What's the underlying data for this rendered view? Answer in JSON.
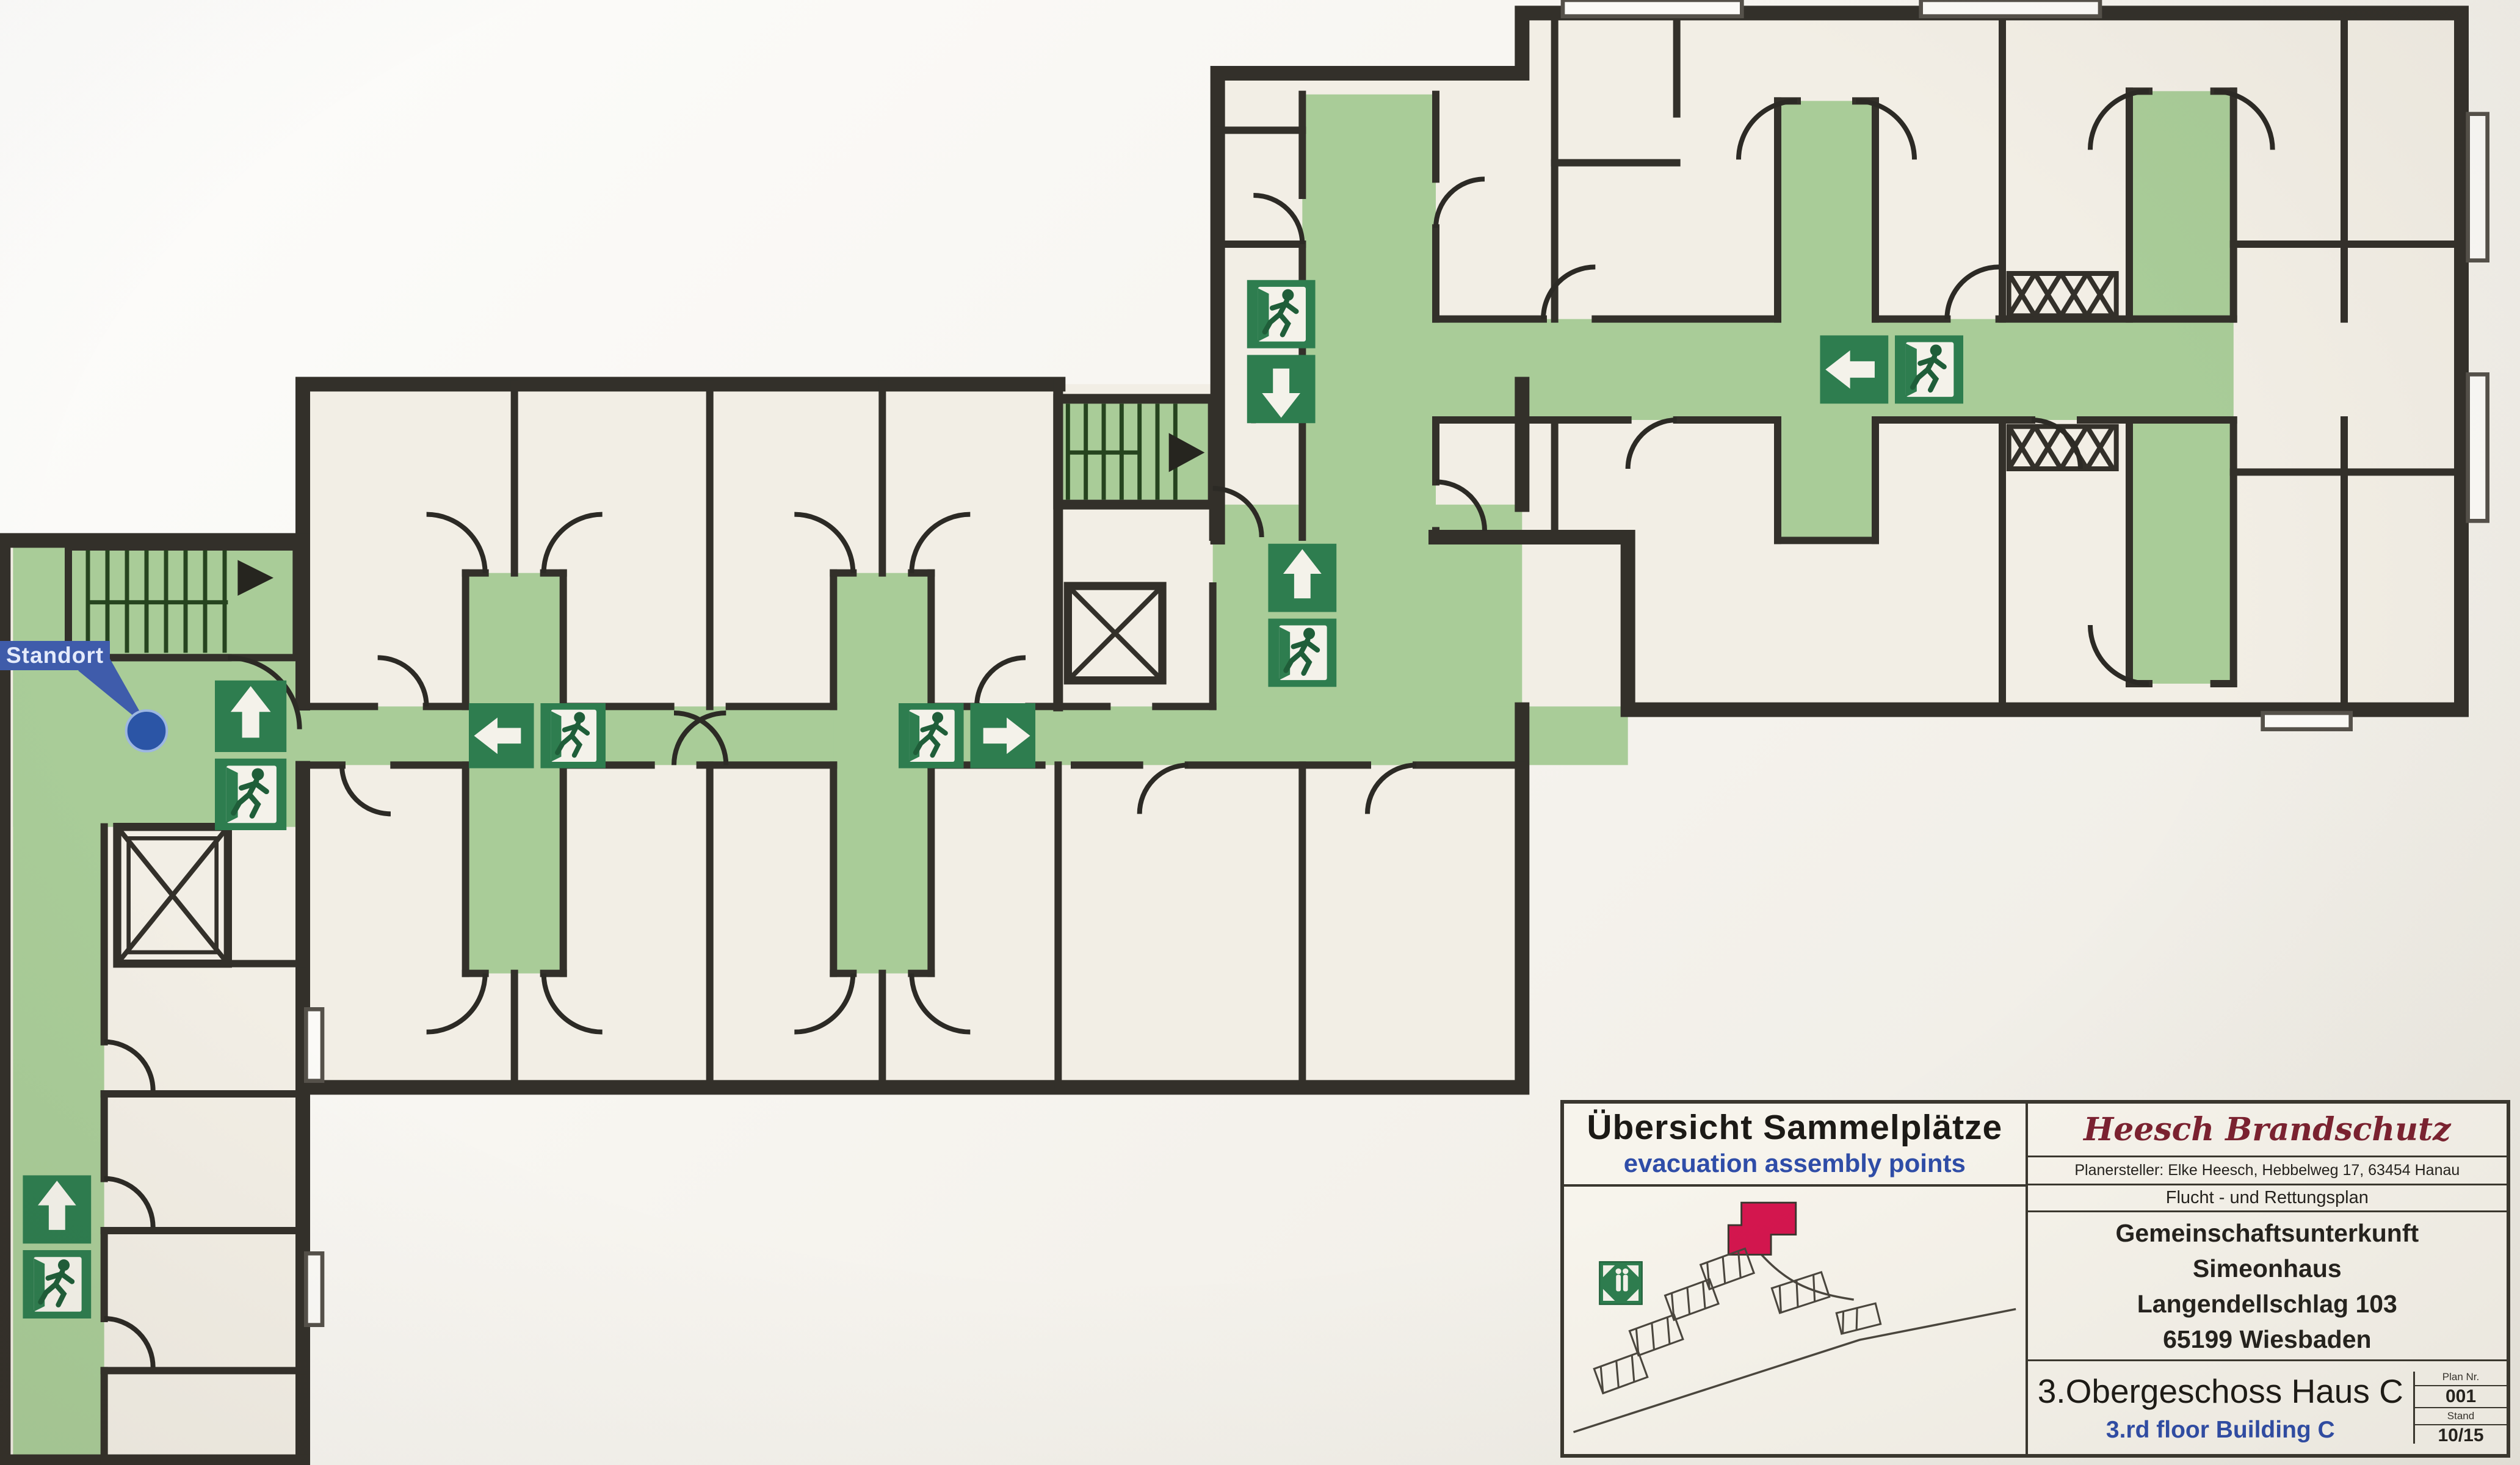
{
  "standort": {
    "label": "Standort"
  },
  "legend": {
    "title_de": "Übersicht Sammelplätze",
    "title_en": "evacuation assembly points",
    "company": "Heesch Brandschutz",
    "planner": "Planersteller: Elke Heesch, Hebbelweg 17, 63454 Hanau",
    "plan_type": "Flucht - und Rettungsplan",
    "facility_line1": "Gemeinschaftsunterkunft",
    "facility_line2": "Simeonhaus",
    "facility_line3": "Langendellschlag 103",
    "facility_line4": "65199 Wiesbaden",
    "floor_de": "3.Obergeschoss Haus C",
    "floor_en": "3.rd floor Building C",
    "plan_nr_label": "Plan Nr.",
    "plan_nr_value": "001",
    "stand_label": "Stand",
    "stand_value": "10/15"
  },
  "colors": {
    "escape_route_green": "#a9cc98",
    "sign_green": "#2e7d4f",
    "assembly_red": "#d4164e",
    "standort_blue": "#3f5cab",
    "location_dot_blue": "#2b55a6",
    "text_blue": "#2f4da8",
    "company_red": "#7c2231",
    "wall": "#33302a"
  },
  "icons": [
    "exit-running-man-icon",
    "arrow-up-icon",
    "arrow-down-icon",
    "arrow-left-icon",
    "arrow-right-icon",
    "assembly-point-icon",
    "staircase-icon",
    "elevator-icon",
    "location-dot-icon"
  ],
  "escape_signs": [
    {
      "area": "right-wing-west-corridor",
      "icons": [
        "exit-running-man",
        "arrow-down"
      ]
    },
    {
      "area": "right-wing-main-corridor",
      "icons": [
        "arrow-left",
        "exit-running-man"
      ]
    },
    {
      "area": "central-junction",
      "icons": [
        "arrow-up",
        "exit-running-man"
      ]
    },
    {
      "area": "middle-wing-corridor-west",
      "icons": [
        "arrow-left",
        "exit-running-man"
      ]
    },
    {
      "area": "middle-wing-corridor-east",
      "icons": [
        "exit-running-man",
        "arrow-right"
      ]
    },
    {
      "area": "left-wing-junction",
      "icons": [
        "arrow-up",
        "exit-running-man"
      ]
    },
    {
      "area": "left-wing-south-corridor",
      "icons": [
        "arrow-up",
        "exit-running-man"
      ]
    }
  ]
}
